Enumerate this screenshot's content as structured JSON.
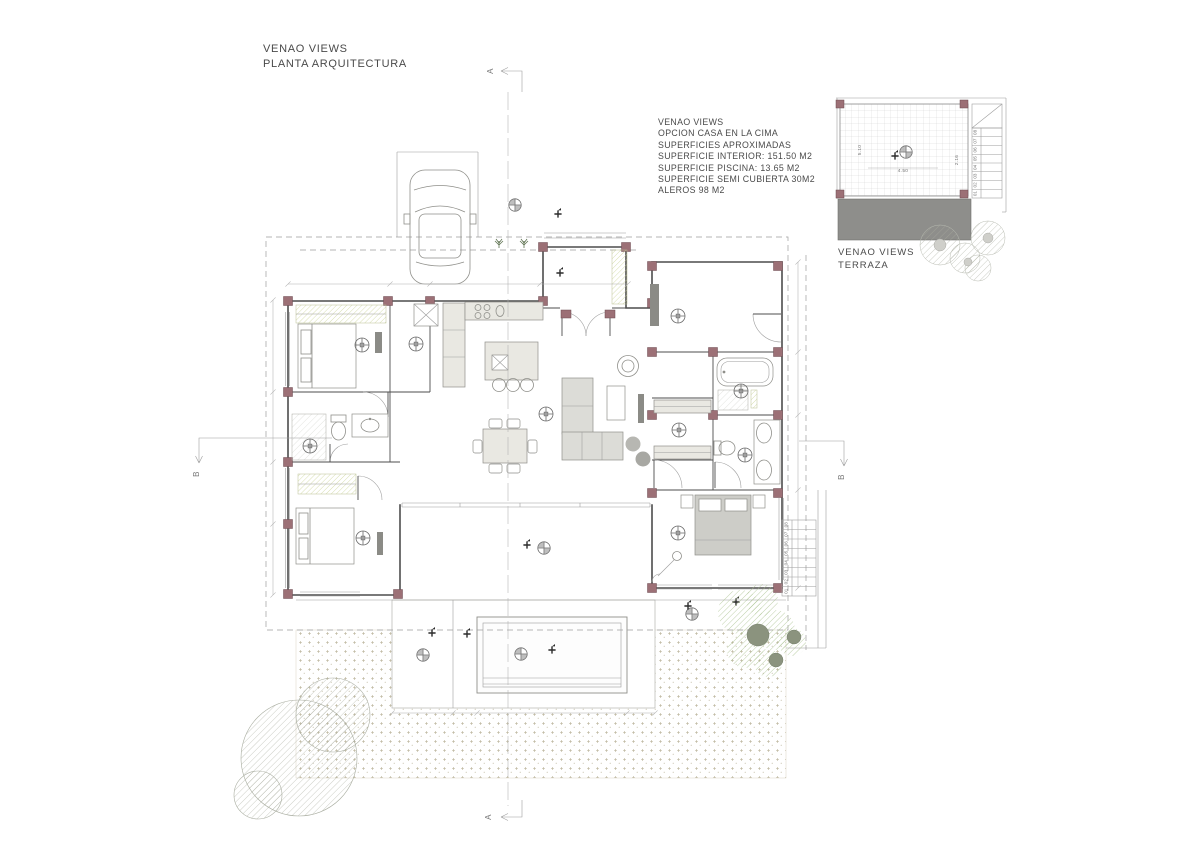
{
  "header": {
    "title": "VENAO VIEWS",
    "subtitle": "PLANTA ARQUITECTURA"
  },
  "info": {
    "lines": [
      "VENAO VIEWS",
      "OPCION CASA EN LA CIMA",
      "SUPERFICIES APROXIMADAS",
      "SUPERFICIE INTERIOR: 151.50 M2",
      "SUPERFICIE PISCINA: 13.65 M2",
      "SUPERFICIE SEMI CUBIERTA 30M2",
      "ALEROS 98 M2"
    ]
  },
  "inset": {
    "label1": "VENAO VIEWS",
    "label2": "TERRAZA",
    "dim_height": "5.10",
    "dim_width": "4.50",
    "dim_side": "2.16",
    "steps": [
      "01",
      "02",
      "03",
      "04",
      "05",
      "06",
      "07",
      "08"
    ]
  },
  "main_stairs": {
    "steps": [
      "01",
      "02",
      "03",
      "04",
      "05",
      "06",
      "07",
      "08"
    ]
  },
  "sections": {
    "top": "A",
    "bottom": "A",
    "left": "B",
    "right": "B"
  },
  "colors": {
    "text": "#4a4a4a",
    "wall": "#4d4d4d",
    "line_light": "#9e9e9e",
    "dim": "#b0b0b0",
    "column": "#9c7076",
    "column_stroke": "#6c4a50",
    "furn_fill": "#e9e8e2",
    "furn_stroke": "#8f8f8a",
    "dark_fixture": "#8b8b86",
    "sofa": "#dcdcd7",
    "bed_grey": "#cdcdc8",
    "roof_grey": "#8e8e8b",
    "closet_hatch": "#c9d293",
    "stipple": "#b3ab8f",
    "tile_line": "#cccccc",
    "tree_grey": "#a9ada0",
    "palm_green": "#a3bd86",
    "trunk": "#8b937e"
  }
}
